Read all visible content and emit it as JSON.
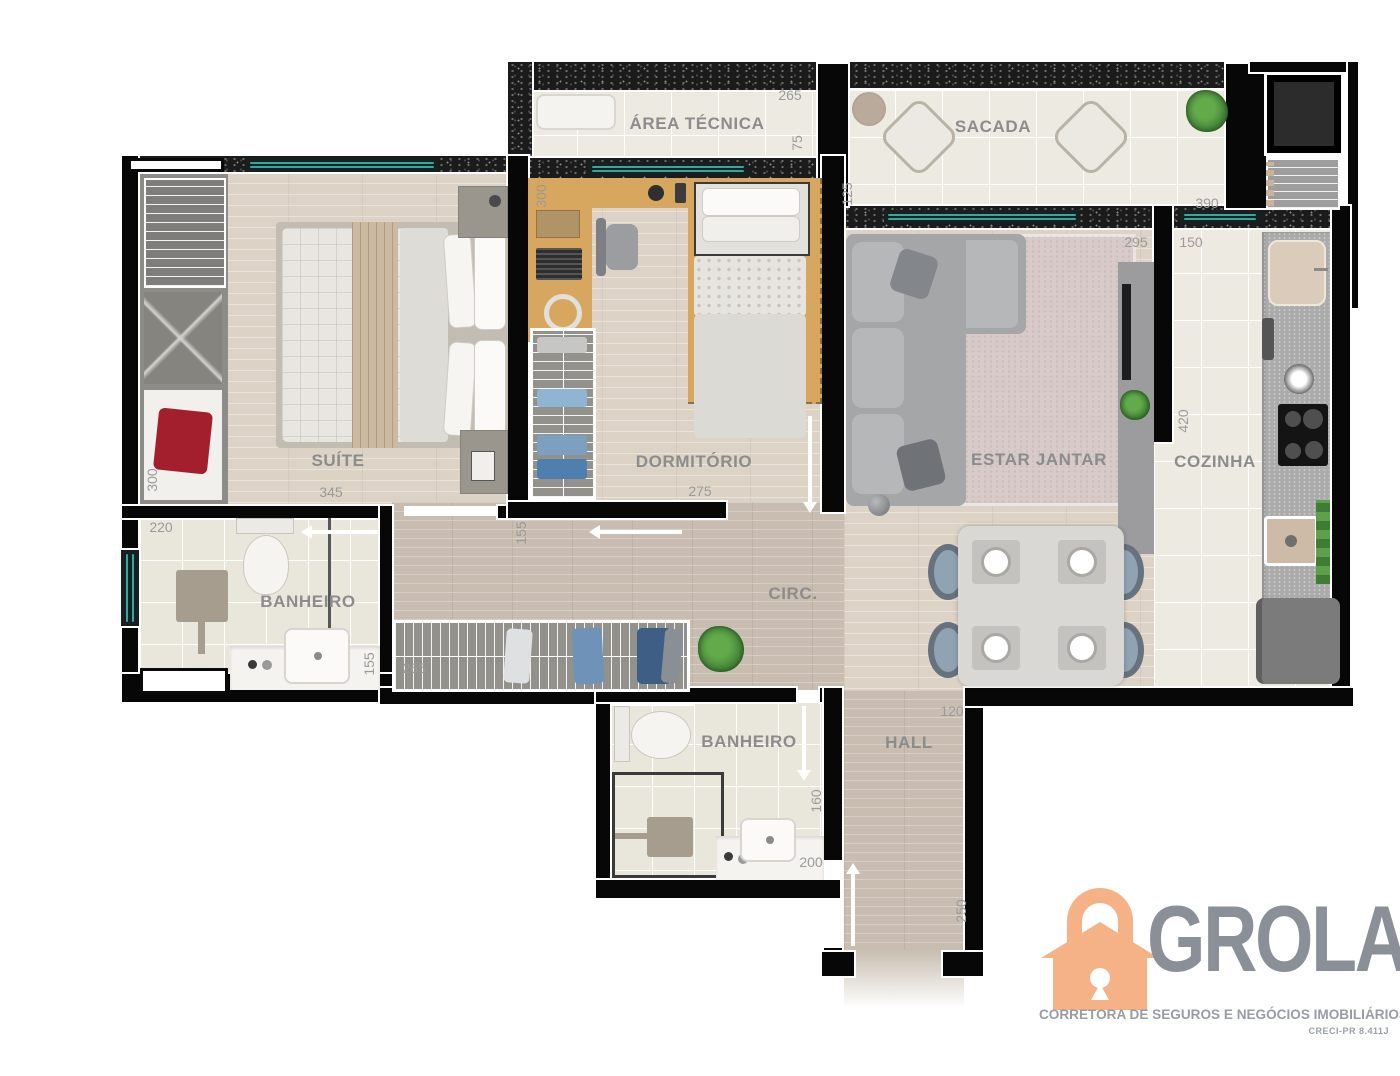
{
  "rooms": {
    "area_tecnica": {
      "name": "ÁREA TÉCNICA",
      "width": "265",
      "depth": "75"
    },
    "sacada": {
      "name": "SACADA",
      "depth": "125",
      "width": "390"
    },
    "suite": {
      "name": "SUÍTE",
      "width": "345",
      "closet_depth": "300"
    },
    "dormitorio": {
      "name": "DORMITÓRIO",
      "width": "275",
      "desk_depth": "300",
      "door_offset": "155"
    },
    "banheiro_suite": {
      "name": "BANHEIRO",
      "width": "220",
      "counter": "155"
    },
    "circulacao": {
      "name": "CIRC.",
      "closet_width": "265"
    },
    "estar_jantar": {
      "name": "ESTAR JANTAR",
      "width": "295"
    },
    "cozinha": {
      "name": "COZINHA",
      "width": "150",
      "depth": "420"
    },
    "banheiro_social": {
      "name": "BANHEIRO",
      "depth": "160",
      "width": "200"
    },
    "hall": {
      "name": "HALL",
      "width": "120",
      "depth": "250"
    }
  },
  "logo": {
    "brand": "GROLA",
    "tagline": "CORRETORA DE SEGUROS E NEGÓCIOS IMOBILIÁRIOS",
    "license": "CRECI-PR 8.411J",
    "accent_color": "#f5b286",
    "text_color": "#8b8f98"
  },
  "colors": {
    "wall": "#070707",
    "window_glass": "#2fa9a2",
    "wood_floor": "#dcd2c5",
    "circulation_floor": "#c8bdb0",
    "tile_floor": "#edebe1",
    "desk_wood": "#d8a75f"
  }
}
